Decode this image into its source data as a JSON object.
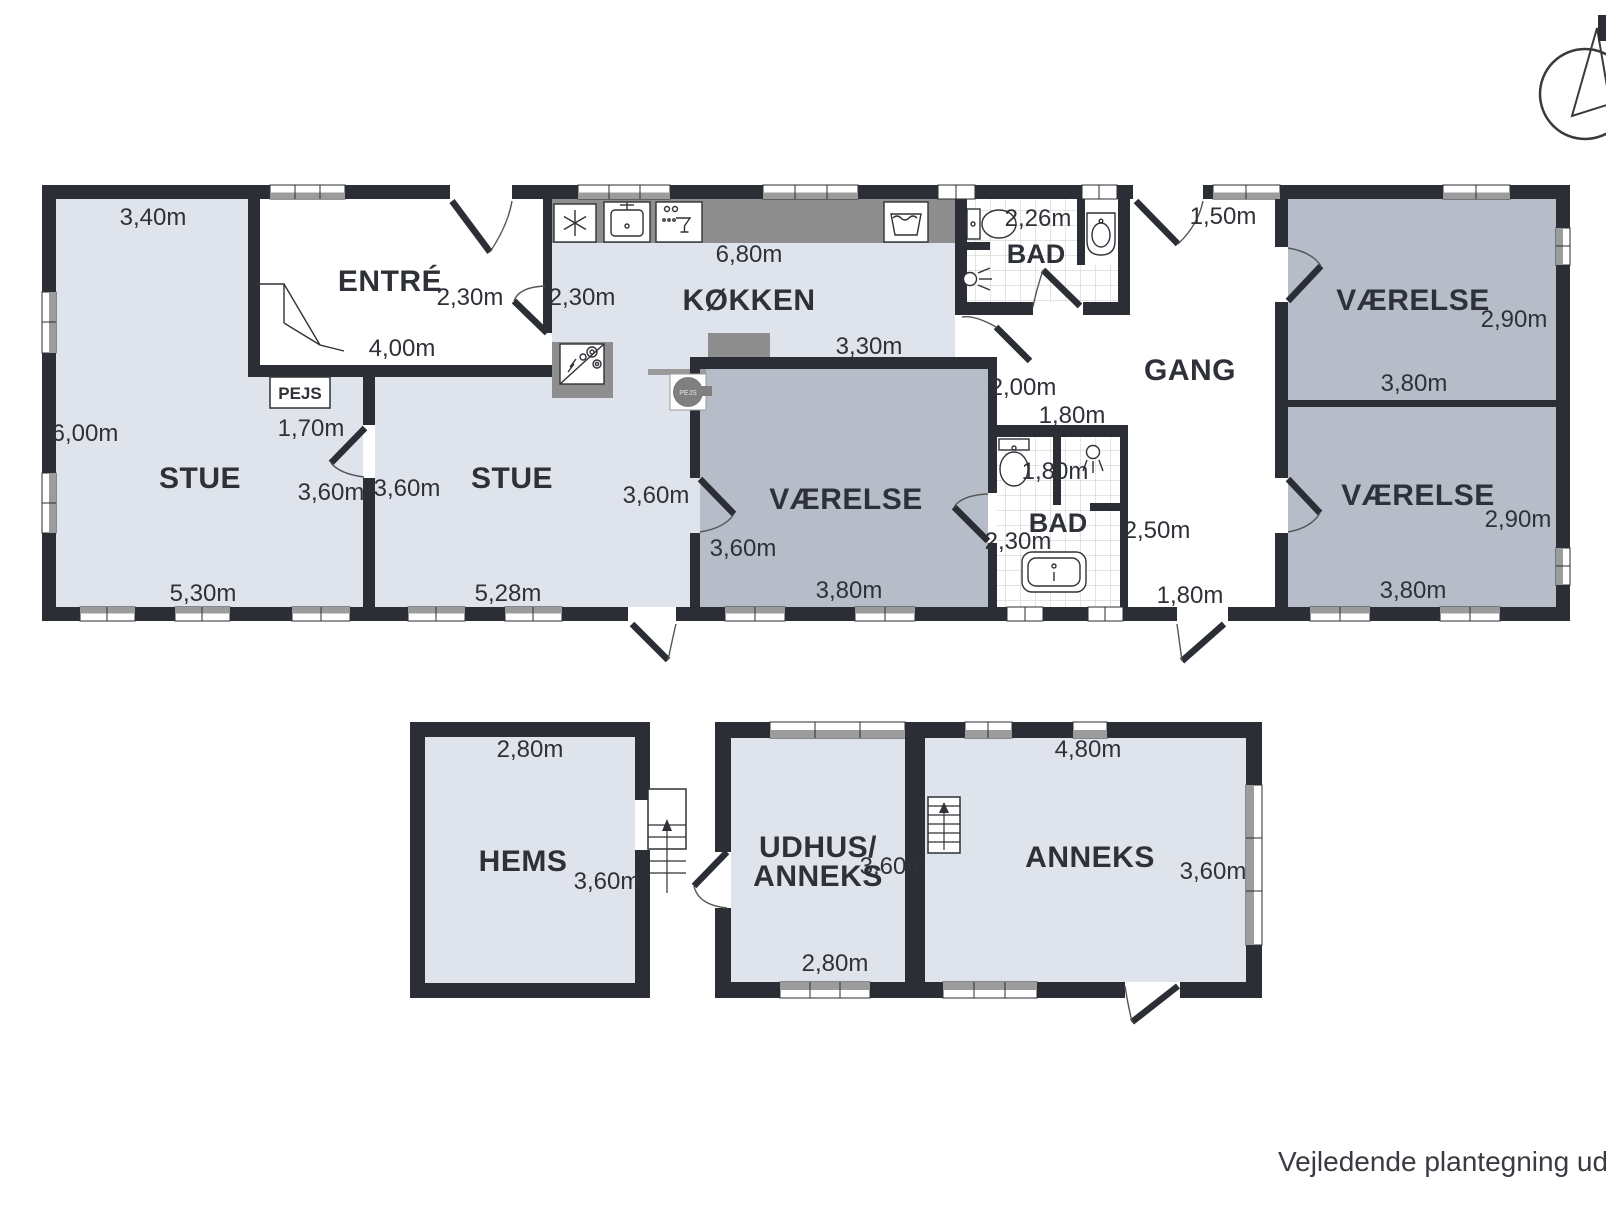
{
  "colors": {
    "wall": "#2b2e34",
    "room_light": "#dfe3eb",
    "room_dark": "#b6bdc9",
    "counter_gray": "#8e8e8e",
    "window_gray": "#9c9c9c",
    "text": "#2e3138",
    "tile_line": "#c9c9c9"
  },
  "main": {
    "stue_left": {
      "name": "STUE",
      "w_top": "3,40m",
      "h_left": "6,00m",
      "w_bottom": "5,30m",
      "door": "3,60m"
    },
    "fireplace": {
      "label": "PEJS",
      "w": "1,70m"
    },
    "fireplace_stove": {
      "label": "PEJS"
    },
    "entre": {
      "name": "ENTRÉ",
      "door": "2,30m",
      "w_bottom": "4,00m"
    },
    "stue_right": {
      "name": "STUE",
      "door": "3,60m",
      "w_bottom": "5,28m"
    },
    "kokken": {
      "name": "KØKKEN",
      "w_top": "6,80m",
      "door": "2,30m",
      "w_bottom": "3,30m"
    },
    "vaerelse_mid": {
      "name": "VÆRELSE",
      "door_out": "3,60m",
      "door_in": "3,60m",
      "w_bottom": "3,80m"
    },
    "bad_top": {
      "name": "BAD",
      "w_top": "2,26m"
    },
    "bad_mid": {
      "name": "BAD",
      "w_top": "1,80m",
      "w_inner": "1,80m",
      "door": "2,30m",
      "h_right": "2,50m"
    },
    "gang": {
      "name": "GANG",
      "door_top": "1,50m",
      "door_bottom": "1,80m",
      "opening": "2,00m"
    },
    "vaerelse_ne": {
      "name": "VÆRELSE",
      "h_right": "2,90m",
      "w_bottom": "3,80m"
    },
    "vaerelse_se": {
      "name": "VÆRELSE",
      "h_right": "2,90m",
      "w_bottom": "3,80m"
    }
  },
  "outbuildings": {
    "hems": {
      "name": "HEMS",
      "w_top": "2,80m",
      "h_right": "3,60m"
    },
    "udhus": {
      "name_line1": "UDHUS/",
      "name_line2": "ANNEKS",
      "h": "3,60m",
      "w_bottom": "2,80m"
    },
    "anneks": {
      "name": "ANNEKS",
      "w_top": "4,80m",
      "h_right": "3,60m"
    }
  },
  "icons": {
    "freezer": "snowflake",
    "kitchen_sink": "basin-with-faucet",
    "dishwasher": "glass",
    "utility_sink": "trough",
    "stove": "hob-with-diagonal",
    "wood_stove": "round-stove",
    "toilet": "wc",
    "shower": "shower-head",
    "bathroom_sink": "pedestal-sink",
    "bathtub": "tub",
    "stairs": "steps-with-up-arrow",
    "compass": "north-arrow"
  },
  "footer": {
    "disclaimer": "Vejledende plantegning uden ans"
  }
}
